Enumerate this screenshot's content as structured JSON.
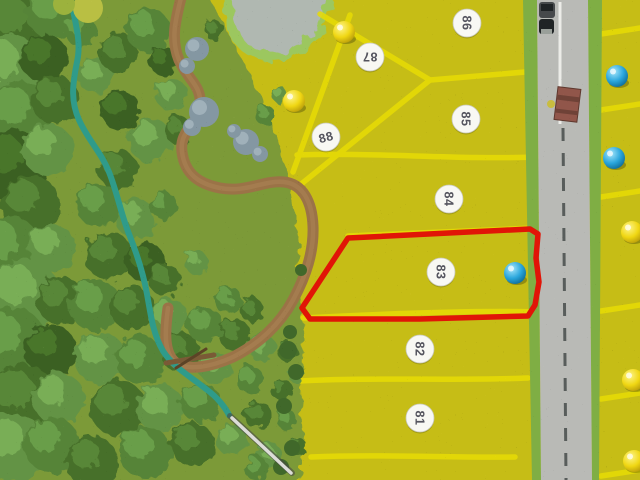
{
  "photo": {
    "alt": "Aerial top-down photo of a miniature scale model of a residential land subdivision: yellow numbered lots 81-88 beside a gray road, forest, stream, pond and winding trail on the left, colored map pins on lots, and lot 83 outlined in red"
  },
  "lot_markers": [
    {
      "label": "88",
      "x": 326,
      "y": 137,
      "rotation": -15
    },
    {
      "label": "87",
      "x": 370,
      "y": 57,
      "rotation": 180
    },
    {
      "label": "86",
      "x": 467,
      "y": 23,
      "rotation": 90
    },
    {
      "label": "85",
      "x": 466,
      "y": 119,
      "rotation": 90
    },
    {
      "label": "84",
      "x": 449,
      "y": 199,
      "rotation": 90
    },
    {
      "label": "83",
      "x": 441,
      "y": 272,
      "rotation": 90
    },
    {
      "label": "82",
      "x": 420,
      "y": 349,
      "rotation": 90
    },
    {
      "label": "81",
      "x": 420,
      "y": 418,
      "rotation": 90
    }
  ],
  "pins": [
    {
      "color": "yellow",
      "x": 344,
      "y": 32
    },
    {
      "color": "yellow",
      "x": 294,
      "y": 101
    },
    {
      "color": "blue",
      "x": 617,
      "y": 76
    },
    {
      "color": "blue",
      "x": 614,
      "y": 158
    },
    {
      "color": "blue",
      "x": 515,
      "y": 273
    },
    {
      "color": "yellow",
      "x": 632,
      "y": 232
    },
    {
      "color": "yellow",
      "x": 633,
      "y": 380
    },
    {
      "color": "yellow",
      "x": 634,
      "y": 461
    }
  ],
  "highlight": {
    "lot": "83",
    "color": "#e11507",
    "points": "348,238 530,229 538,234 536,258 539,282 535,305 528,316 420,319 310,319 302,308"
  },
  "scene_objects": {
    "vehicles": "two dark vehicles parked on road (top)",
    "building": "small red-brown roofed structure beside road",
    "pointer_stick": "white stick lying across bottom-left lots edge",
    "water": "gray pond at top and teal stream through forest",
    "trail": "brown winding walking trail"
  },
  "palette": {
    "grass_yellow": "#c6bd17",
    "grass_green": "#7c9a38",
    "division_line": "#e8dc05",
    "road": "#b9bab6",
    "road_dash": "#585d5b",
    "stream": "#2f9b8a",
    "trail": "#9b7347",
    "pond": "#b0b8b1",
    "pond_rim": "#9cc75e",
    "highlight_red": "#e11507",
    "pin_blue": "#2aa6dc",
    "pin_yellow": "#f0d713"
  }
}
